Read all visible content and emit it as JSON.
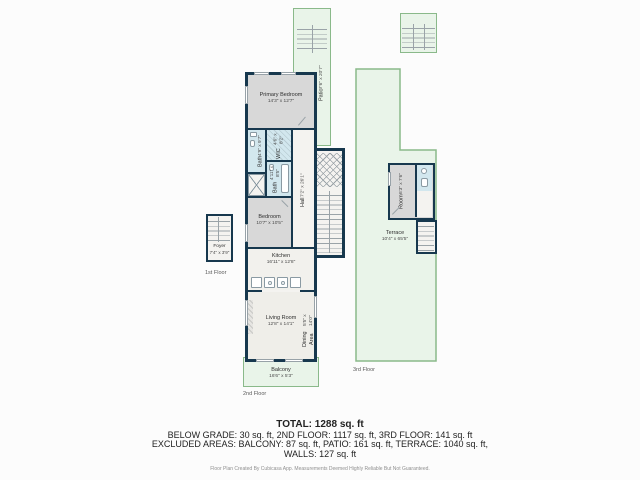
{
  "colors": {
    "wall": "#17384e",
    "green_line": "#8ab98a",
    "green_fill": "#e9f4e9",
    "bath_fill": "#d2e7ee",
    "room_gray": "#d8d8d8",
    "floor_white": "#f4f3f0",
    "text_dark": "#222222",
    "text_muted": "#8f8f8f"
  },
  "floors": {
    "first": {
      "label": "1st Floor",
      "rooms": {
        "foyer": {
          "name": "Foyer",
          "dims": "7'4\" x 3'9\""
        }
      }
    },
    "second": {
      "label": "2nd Floor",
      "rooms": {
        "primary_bedroom": {
          "name": "Primary Bedroom",
          "dims": "14'3\" x 12'7\""
        },
        "bath1": {
          "name": "Bath",
          "dims": "4'9\" x 9'7\""
        },
        "wic": {
          "name": "WIC",
          "dims": "4'6\" x 8'2\""
        },
        "bath2": {
          "name": "Bath",
          "dims": "4'11\" x 8'5\""
        },
        "hall": {
          "name": "Hall",
          "dims": "7'2\" x 26'1\""
        },
        "bedroom": {
          "name": "Bedroom",
          "dims": "10'7\" x 10'5\""
        },
        "kitchen": {
          "name": "Kitchen",
          "dims": "16'11\" x 12'8\""
        },
        "living_room": {
          "name": "Living Room",
          "dims": "12'8\" x 14'1\""
        },
        "dining_area": {
          "name": "Dining Area",
          "dims": "5'5\" x 14'0\""
        },
        "balcony": {
          "name": "Balcony",
          "dims": "16'6\" x 5'3\""
        },
        "patio": {
          "name": "Patio",
          "dims": "7'6\" x 20'7\""
        }
      }
    },
    "third": {
      "label": "3rd Floor",
      "rooms": {
        "room": {
          "name": "Room",
          "dims": "6'3\" x 7'6\""
        },
        "terrace": {
          "name": "Terrace",
          "dims": "10'4\" x 65'5\""
        }
      }
    }
  },
  "summary": {
    "total": "TOTAL: 1288 sq. ft",
    "line1": "BELOW GRADE: 30 sq. ft, 2ND FLOOR: 1117 sq. ft, 3RD FLOOR: 141 sq. ft",
    "line2": "EXCLUDED AREAS: BALCONY: 87 sq. ft, PATIO: 161 sq. ft, TERRACE: 1040 sq. ft,",
    "line3": "WALLS: 127 sq. ft",
    "disclaimer": "Floor Plan Created By Cubicasa App. Measurements Deemed Highly Reliable But Not Guaranteed."
  }
}
